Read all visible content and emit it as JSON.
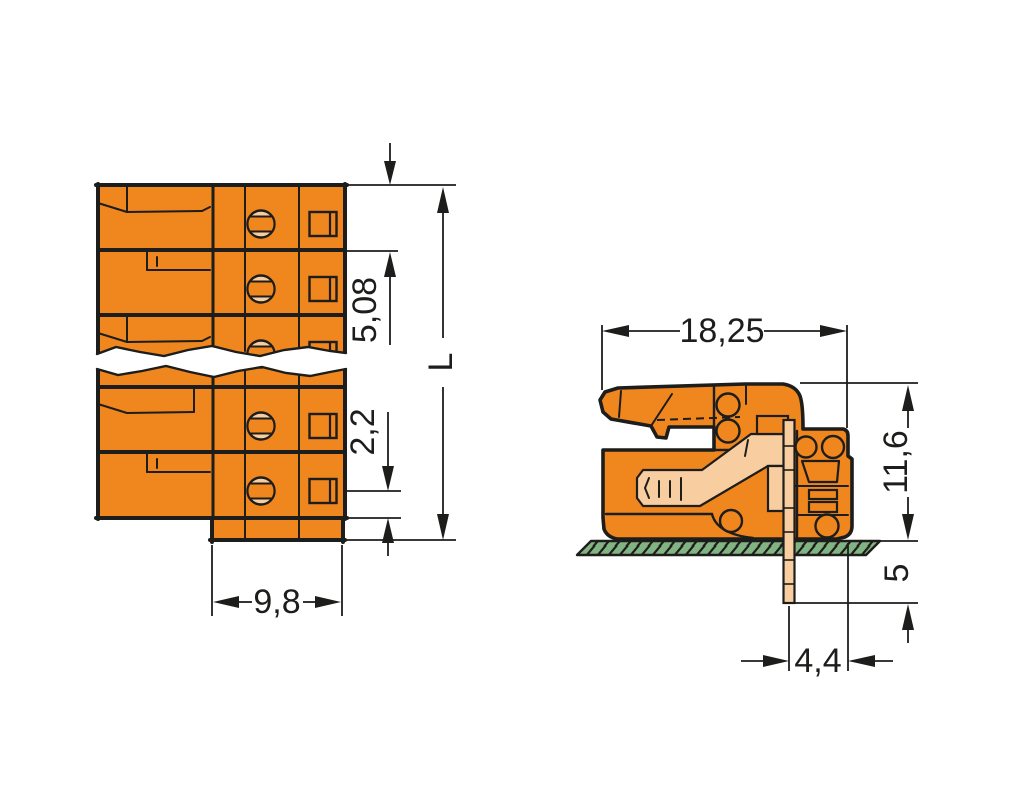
{
  "drawing": {
    "type": "technical-dimension-drawing",
    "subject": "pcb-terminal-connector-two-views",
    "colors": {
      "body_orange": "#F0861E",
      "contact_peach": "#F8CD9F",
      "pcb_green": "#82B382",
      "outline_black": "#1D1D1B",
      "background": "#FFFFFF"
    },
    "front_view": {
      "pitch": "5,08",
      "pole_offset": "2,2",
      "overall_length": "L",
      "depth": "9,8"
    },
    "side_view": {
      "width": "18,25",
      "height": "11,6",
      "pin_length": "5",
      "pin_offset": "4,4"
    }
  }
}
